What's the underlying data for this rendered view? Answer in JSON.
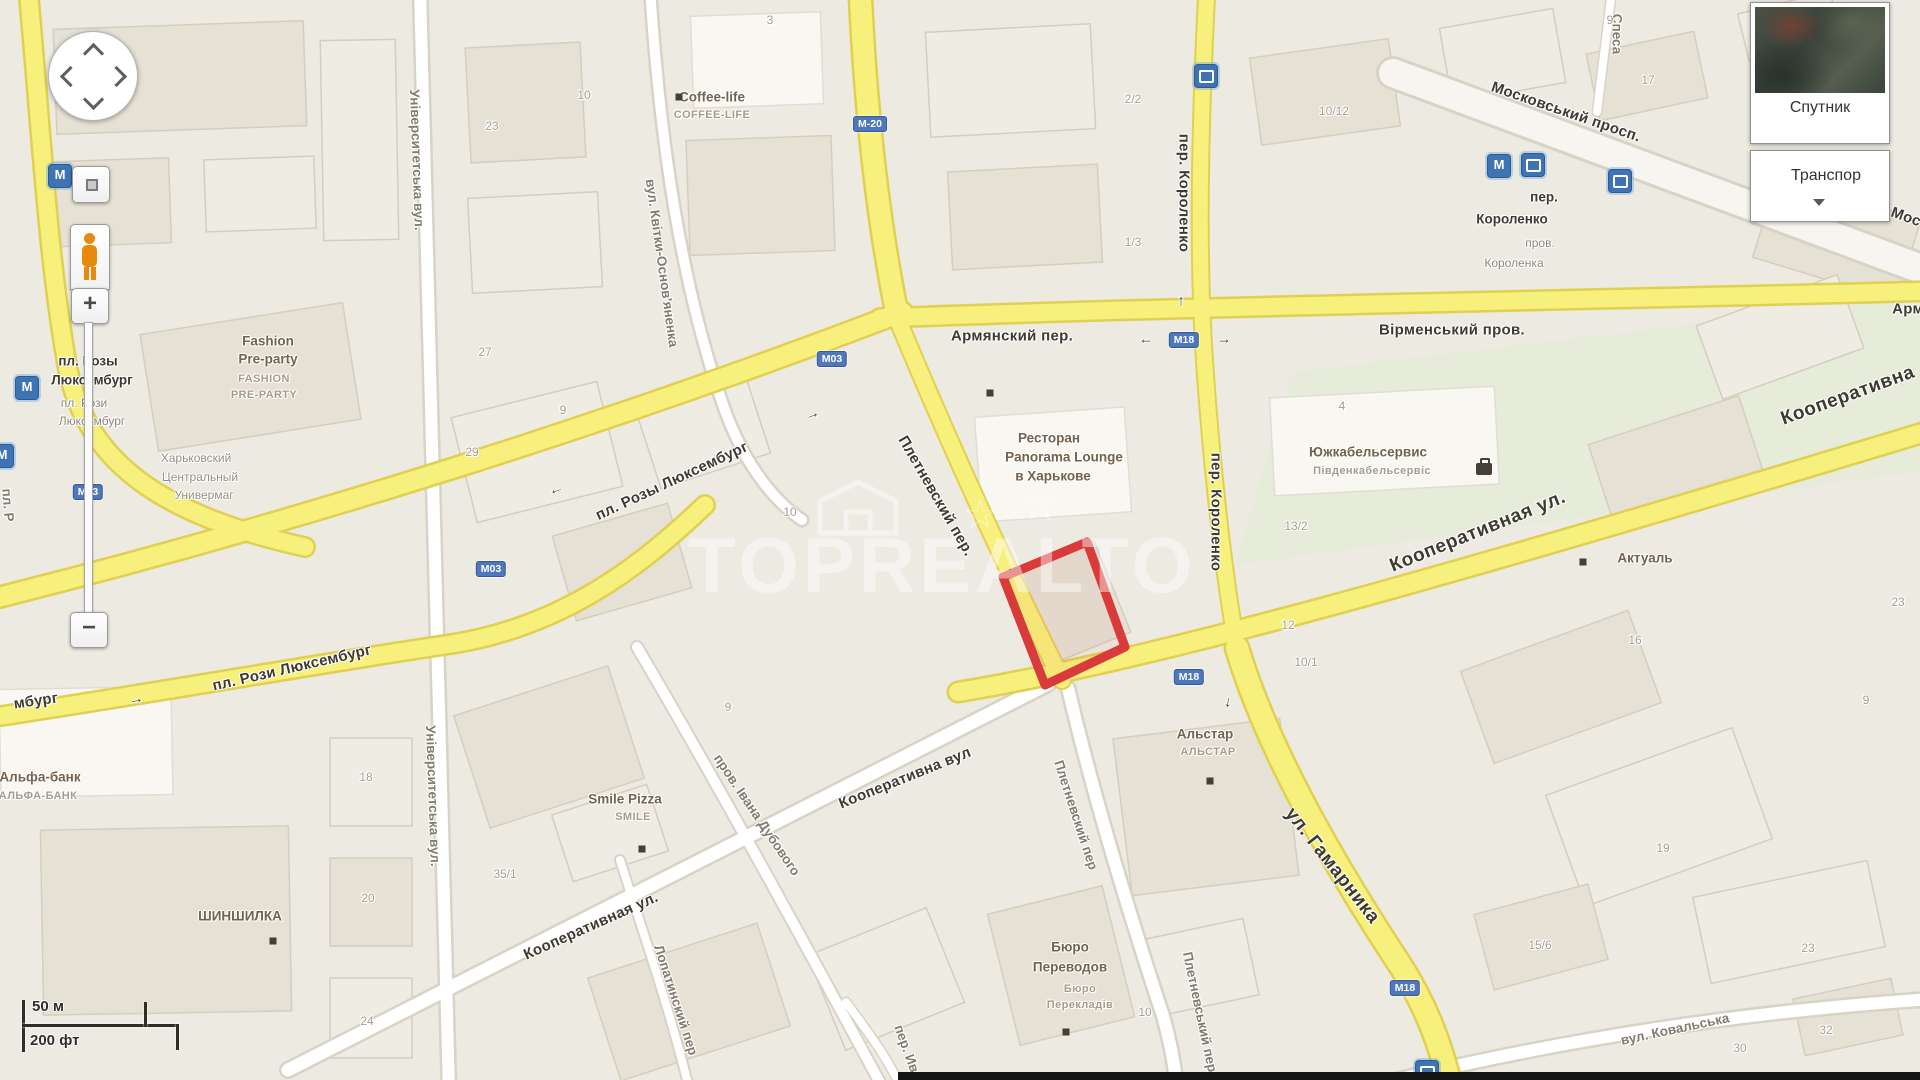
{
  "app": {
    "name": "Карта"
  },
  "watermark_text": "TOPREALTO",
  "highlight": {
    "color": "#D93B3B"
  },
  "controls": {
    "zoom_in_label": "+",
    "zoom_out_label": "−",
    "layer_satellite_label": "Спутник",
    "layer_transport_label": "Транспор",
    "scale": {
      "metric": "50 м",
      "imperial": "200 фт"
    }
  },
  "map": {
    "road_shields": [
      {
        "t": "М-20",
        "x": 870,
        "y": 124
      },
      {
        "t": "М03",
        "x": 88,
        "y": 492
      },
      {
        "t": "М03",
        "x": 491,
        "y": 569
      },
      {
        "t": "М03",
        "x": 832,
        "y": 359
      },
      {
        "t": "М18",
        "x": 1184,
        "y": 340
      },
      {
        "t": "М18",
        "x": 1189,
        "y": 677
      },
      {
        "t": "М18",
        "x": 1405,
        "y": 988
      }
    ],
    "labels": [
      {
        "t": "Армянский пер.",
        "x": 1012,
        "y": 336,
        "r": 0,
        "k": "road1"
      },
      {
        "t": "Вірменський пров.",
        "x": 1452,
        "y": 330,
        "r": 0,
        "k": "road1"
      },
      {
        "t": "Арм",
        "x": 1908,
        "y": 309,
        "r": 0,
        "k": "road1"
      },
      {
        "t": "Московський просп.",
        "x": 1566,
        "y": 112,
        "r": 19,
        "k": "road1"
      },
      {
        "t": "Мос",
        "x": 1906,
        "y": 217,
        "r": 20,
        "k": "road1"
      },
      {
        "t": "пл. Розы Люксембург",
        "x": 672,
        "y": 481,
        "r": -25,
        "k": "road1"
      },
      {
        "t": "пл. Рози Люксембург",
        "x": 292,
        "y": 668,
        "r": -13,
        "k": "road1"
      },
      {
        "t": "мбург",
        "x": 36,
        "y": 701,
        "r": -8,
        "k": "road1"
      },
      {
        "t": "Плетневский пер.",
        "x": 936,
        "y": 496,
        "r": 60,
        "k": "road1"
      },
      {
        "t": "Кооперативная ул.",
        "x": 1478,
        "y": 532,
        "r": -22,
        "k": "road1big"
      },
      {
        "t": "Кооперативна",
        "x": 1848,
        "y": 396,
        "r": -20,
        "k": "road1big"
      },
      {
        "t": "ул. Гамарника",
        "x": 1332,
        "y": 866,
        "r": 52,
        "k": "road1big"
      },
      {
        "t": "Кооперативна вул",
        "x": 905,
        "y": 778,
        "r": -22,
        "k": "road1"
      },
      {
        "t": "Кооперативная ул.",
        "x": 591,
        "y": 926,
        "r": -24,
        "k": "road1"
      },
      {
        "t": "вул. Ковальська",
        "x": 1675,
        "y": 1029,
        "r": -12,
        "k": "road2"
      },
      {
        "t": "пер. Короленко",
        "x": 1184,
        "y": 193,
        "r": 90,
        "k": "road1"
      },
      {
        "t": "пер. Короленко",
        "x": 1216,
        "y": 512,
        "r": 90,
        "k": "road1"
      },
      {
        "t": "Спеса",
        "x": 1617,
        "y": 34,
        "r": 90,
        "k": "road2"
      },
      {
        "t": "пл. Р",
        "x": 8,
        "y": 505,
        "r": 85,
        "k": "road2"
      },
      {
        "t": "Університетська вул.",
        "x": 417,
        "y": 160,
        "r": 88,
        "k": "road2"
      },
      {
        "t": "Університетська вул.",
        "x": 433,
        "y": 796,
        "r": 88,
        "k": "road2"
      },
      {
        "t": "вул. Квітки-Основ'яненка",
        "x": 662,
        "y": 263,
        "r": 82,
        "k": "road2"
      },
      {
        "t": "пров. Івана Дубового",
        "x": 757,
        "y": 815,
        "r": 56,
        "k": "road2"
      },
      {
        "t": "Лопатинский пер",
        "x": 676,
        "y": 1000,
        "r": 72,
        "k": "road2"
      },
      {
        "t": "пер. Ива",
        "x": 908,
        "y": 1052,
        "r": 70,
        "k": "road2"
      },
      {
        "t": "Плетневский пер",
        "x": 1076,
        "y": 815,
        "r": 72,
        "k": "road2"
      },
      {
        "t": "Плетневський пер",
        "x": 1200,
        "y": 1012,
        "r": 78,
        "k": "road2"
      },
      {
        "t": "Coffee-life",
        "x": 712,
        "y": 97,
        "r": 0,
        "k": "poi"
      },
      {
        "t": "COFFEE-LIFE",
        "x": 712,
        "y": 115,
        "r": 0,
        "k": "poisub"
      },
      {
        "t": "Fashion",
        "x": 268,
        "y": 341,
        "r": 0,
        "k": "poi"
      },
      {
        "t": "Pre-party",
        "x": 268,
        "y": 359,
        "r": 0,
        "k": "poi"
      },
      {
        "t": "FASHION",
        "x": 264,
        "y": 379,
        "r": 0,
        "k": "poisub"
      },
      {
        "t": "PRE-PARTY",
        "x": 264,
        "y": 395,
        "r": 0,
        "k": "poisub"
      },
      {
        "t": "Ресторан",
        "x": 1049,
        "y": 438,
        "r": 0,
        "k": "poi"
      },
      {
        "t": "Panorama Lounge",
        "x": 1064,
        "y": 457,
        "r": 0,
        "k": "poi"
      },
      {
        "t": "в Харькове",
        "x": 1053,
        "y": 476,
        "r": 0,
        "k": "poi"
      },
      {
        "t": "Южкабельсервис",
        "x": 1368,
        "y": 452,
        "r": 0,
        "k": "poi"
      },
      {
        "t": "Південкабельсервіс",
        "x": 1372,
        "y": 471,
        "r": 0,
        "k": "poisub"
      },
      {
        "t": "Актуаль",
        "x": 1645,
        "y": 558,
        "r": 0,
        "k": "poi"
      },
      {
        "t": "Альстар",
        "x": 1205,
        "y": 734,
        "r": 0,
        "k": "poi"
      },
      {
        "t": "АЛЬСТАР",
        "x": 1208,
        "y": 752,
        "r": 0,
        "k": "poisub"
      },
      {
        "t": "Бюро",
        "x": 1070,
        "y": 947,
        "r": 0,
        "k": "poi"
      },
      {
        "t": "Переводов",
        "x": 1070,
        "y": 967,
        "r": 0,
        "k": "poi"
      },
      {
        "t": "Бюро",
        "x": 1080,
        "y": 989,
        "r": 0,
        "k": "poisub"
      },
      {
        "t": "Перекладів",
        "x": 1080,
        "y": 1005,
        "r": 0,
        "k": "poisub"
      },
      {
        "t": "Smile Pizza",
        "x": 625,
        "y": 799,
        "r": 0,
        "k": "poi"
      },
      {
        "t": "SMILE",
        "x": 633,
        "y": 817,
        "r": 0,
        "k": "poisub"
      },
      {
        "t": "ШИНШИЛКА",
        "x": 240,
        "y": 916,
        "r": 0,
        "k": "poi"
      },
      {
        "t": "Альфа-банк",
        "x": 40,
        "y": 777,
        "r": 0,
        "k": "poi"
      },
      {
        "t": "АЛЬФА-БАНК",
        "x": 38,
        "y": 796,
        "r": 0,
        "k": "poisub"
      },
      {
        "t": "Харьковский",
        "x": 196,
        "y": 458,
        "r": 0,
        "k": "gray"
      },
      {
        "t": "Центральный",
        "x": 200,
        "y": 477,
        "r": 0,
        "k": "gray"
      },
      {
        "t": "Универмаг",
        "x": 204,
        "y": 495,
        "r": 0,
        "k": "gray"
      },
      {
        "t": "пл. Розы",
        "x": 88,
        "y": 361,
        "r": 0,
        "k": "metro"
      },
      {
        "t": "Люксембург",
        "x": 92,
        "y": 380,
        "r": 0,
        "k": "metro"
      },
      {
        "t": "пл. Рози",
        "x": 84,
        "y": 403,
        "r": 0,
        "k": "metrosub"
      },
      {
        "t": "Люксембург",
        "x": 92,
        "y": 421,
        "r": 0,
        "k": "metrosub"
      },
      {
        "t": "пер.",
        "x": 1544,
        "y": 197,
        "r": 0,
        "k": "metro"
      },
      {
        "t": "Короленко",
        "x": 1512,
        "y": 219,
        "r": 0,
        "k": "metro"
      },
      {
        "t": "пров.",
        "x": 1540,
        "y": 243,
        "r": 0,
        "k": "metrosub"
      },
      {
        "t": "Короленка",
        "x": 1514,
        "y": 263,
        "r": 0,
        "k": "metrosub"
      },
      {
        "t": "10",
        "x": 584,
        "y": 95,
        "r": 0,
        "k": "num"
      },
      {
        "t": "23",
        "x": 492,
        "y": 126,
        "r": 0,
        "k": "num"
      },
      {
        "t": "3",
        "x": 770,
        "y": 20,
        "r": 0,
        "k": "num"
      },
      {
        "t": "27",
        "x": 485,
        "y": 352,
        "r": 0,
        "k": "num"
      },
      {
        "t": "9",
        "x": 563,
        "y": 410,
        "r": 0,
        "k": "num"
      },
      {
        "t": "29",
        "x": 472,
        "y": 452,
        "r": 0,
        "k": "num"
      },
      {
        "t": "10",
        "x": 790,
        "y": 512,
        "r": 0,
        "k": "num"
      },
      {
        "t": "2/2",
        "x": 1133,
        "y": 99,
        "r": 0,
        "k": "num"
      },
      {
        "t": "10/12",
        "x": 1334,
        "y": 111,
        "r": 0,
        "k": "num"
      },
      {
        "t": "1/3",
        "x": 1133,
        "y": 242,
        "r": 0,
        "k": "num"
      },
      {
        "t": "9",
        "x": 1610,
        "y": 20,
        "r": 0,
        "k": "num"
      },
      {
        "t": "3",
        "x": 1812,
        "y": 14,
        "r": 0,
        "k": "num"
      },
      {
        "t": "17",
        "x": 1648,
        "y": 80,
        "r": 0,
        "k": "num"
      },
      {
        "t": "4",
        "x": 1342,
        "y": 406,
        "r": 0,
        "k": "num"
      },
      {
        "t": "13/2",
        "x": 1296,
        "y": 526,
        "r": 0,
        "k": "num"
      },
      {
        "t": "12",
        "x": 1288,
        "y": 625,
        "r": 0,
        "k": "num"
      },
      {
        "t": "10/1",
        "x": 1306,
        "y": 662,
        "r": 0,
        "k": "num"
      },
      {
        "t": "16",
        "x": 1635,
        "y": 640,
        "r": 0,
        "k": "num"
      },
      {
        "t": "23",
        "x": 1898,
        "y": 602,
        "r": 0,
        "k": "num"
      },
      {
        "t": "9",
        "x": 1866,
        "y": 700,
        "r": 0,
        "k": "num"
      },
      {
        "t": "18",
        "x": 366,
        "y": 777,
        "r": 0,
        "k": "num"
      },
      {
        "t": "20",
        "x": 368,
        "y": 898,
        "r": 0,
        "k": "num"
      },
      {
        "t": "24",
        "x": 367,
        "y": 1021,
        "r": 0,
        "k": "num"
      },
      {
        "t": "35/1",
        "x": 505,
        "y": 874,
        "r": 0,
        "k": "num"
      },
      {
        "t": "9",
        "x": 728,
        "y": 707,
        "r": 0,
        "k": "num"
      },
      {
        "t": "10",
        "x": 1145,
        "y": 1012,
        "r": 0,
        "k": "num"
      },
      {
        "t": "19",
        "x": 1663,
        "y": 848,
        "r": 0,
        "k": "num"
      },
      {
        "t": "15/6",
        "x": 1540,
        "y": 945,
        "r": 0,
        "k": "num"
      },
      {
        "t": "23",
        "x": 1808,
        "y": 948,
        "r": 0,
        "k": "num"
      },
      {
        "t": "32",
        "x": 1826,
        "y": 1030,
        "r": 0,
        "k": "num"
      },
      {
        "t": "30",
        "x": 1740,
        "y": 1048,
        "r": 0,
        "k": "num"
      }
    ],
    "arrows": [
      {
        "t": "←",
        "x": 1146,
        "y": 339,
        "r": 0
      },
      {
        "t": "→",
        "x": 1224,
        "y": 339,
        "r": 0
      },
      {
        "t": "→",
        "x": 812,
        "y": 414,
        "r": -20
      },
      {
        "t": "←",
        "x": 556,
        "y": 489,
        "r": -17
      },
      {
        "t": "→",
        "x": 136,
        "y": 699,
        "r": -8
      },
      {
        "t": "↓",
        "x": 1228,
        "y": 702,
        "r": 8
      },
      {
        "t": "↑",
        "x": 1181,
        "y": 301,
        "r": 0
      }
    ],
    "transit_icons": [
      {
        "type": "metro",
        "x": 27,
        "y": 388
      },
      {
        "type": "metro",
        "x": 60,
        "y": 176
      },
      {
        "type": "metro",
        "x": 2,
        "y": 456
      },
      {
        "type": "bus",
        "x": 1206,
        "y": 76
      },
      {
        "type": "metro",
        "x": 1499,
        "y": 166
      },
      {
        "type": "bus",
        "x": 1533,
        "y": 165
      },
      {
        "type": "bus",
        "x": 1620,
        "y": 181
      },
      {
        "type": "bus",
        "x": 1427,
        "y": 1072
      }
    ],
    "poi_markers": [
      {
        "x": 679,
        "y": 97
      },
      {
        "x": 990,
        "y": 393
      },
      {
        "x": 1583,
        "y": 562
      },
      {
        "x": 1210,
        "y": 781
      },
      {
        "x": 1066,
        "y": 1032
      },
      {
        "x": 642,
        "y": 849
      },
      {
        "x": 273,
        "y": 941
      },
      {
        "type": "bag",
        "x": 1484,
        "y": 469
      }
    ]
  }
}
